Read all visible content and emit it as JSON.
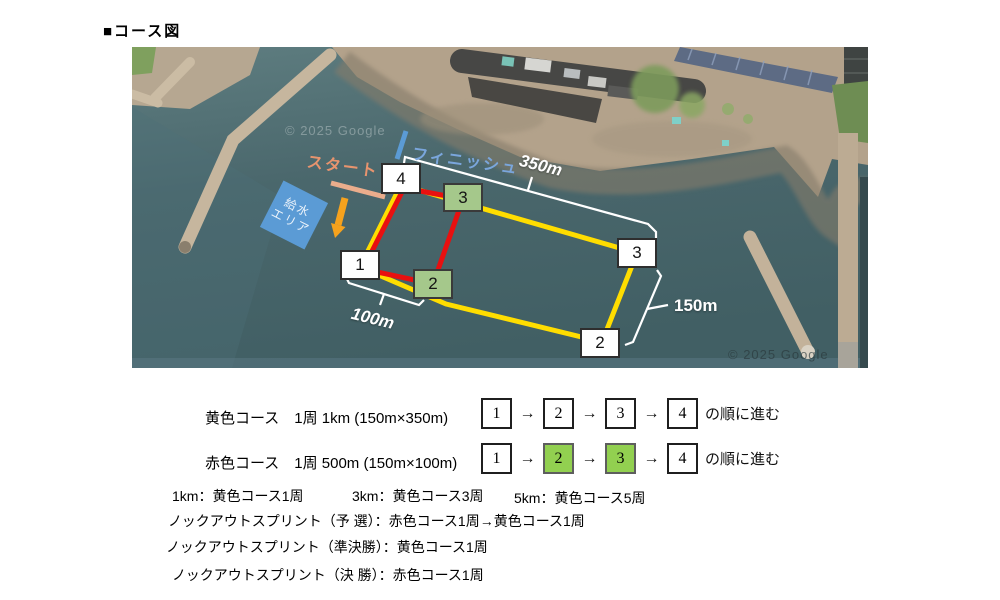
{
  "title": "■コース図",
  "map": {
    "watermark": "© 2025 Google",
    "labels": {
      "start": "スタート",
      "finish": "フィニッシュ",
      "water_area_line1": "給水",
      "water_area_line2": "エリア",
      "dist_top": "350m",
      "dist_right": "150m",
      "dist_bottom": "100m"
    },
    "markers": [
      {
        "label": "4"
      },
      {
        "label": "3"
      },
      {
        "label": "1"
      },
      {
        "label": "2"
      },
      {
        "label": "3"
      },
      {
        "label": "2"
      }
    ],
    "colors": {
      "yellow_course": "#ffdd00",
      "red_course": "#e81010",
      "water_area_blue": "#5b9bd5",
      "start_line_salmon": "#ebad8c",
      "finish_line_blue": "#5b9bd5",
      "arrow_orange": "#f6a21d",
      "marker_green": "#a5c88b",
      "legend_green": "#92d050"
    }
  },
  "legend": {
    "arrow_char": "→",
    "rows": [
      {
        "text": "黄色コース　1周 1km (150m×350m)",
        "sequence": [
          {
            "label": "1"
          },
          {
            "label": "2"
          },
          {
            "label": "3"
          },
          {
            "label": "4"
          }
        ],
        "suffix": "の順に進む"
      },
      {
        "text": "赤色コース　1周 500m (150m×100m)",
        "sequence": [
          {
            "label": "1"
          },
          {
            "label": "2"
          },
          {
            "label": "3"
          },
          {
            "label": "4"
          }
        ],
        "suffix": "の順に進む"
      }
    ],
    "distances": [
      "1km：黄色コース1周",
      "3km：黄色コース3周",
      "5km：黄色コース5周"
    ],
    "knockout": [
      "ノックアウトスプリント（予 選）：赤色コース1周→黄色コース1周",
      "ノックアウトスプリント（準決勝）：黄色コース1周",
      "ノックアウトスプリント（決 勝）：赤色コース1周"
    ]
  }
}
